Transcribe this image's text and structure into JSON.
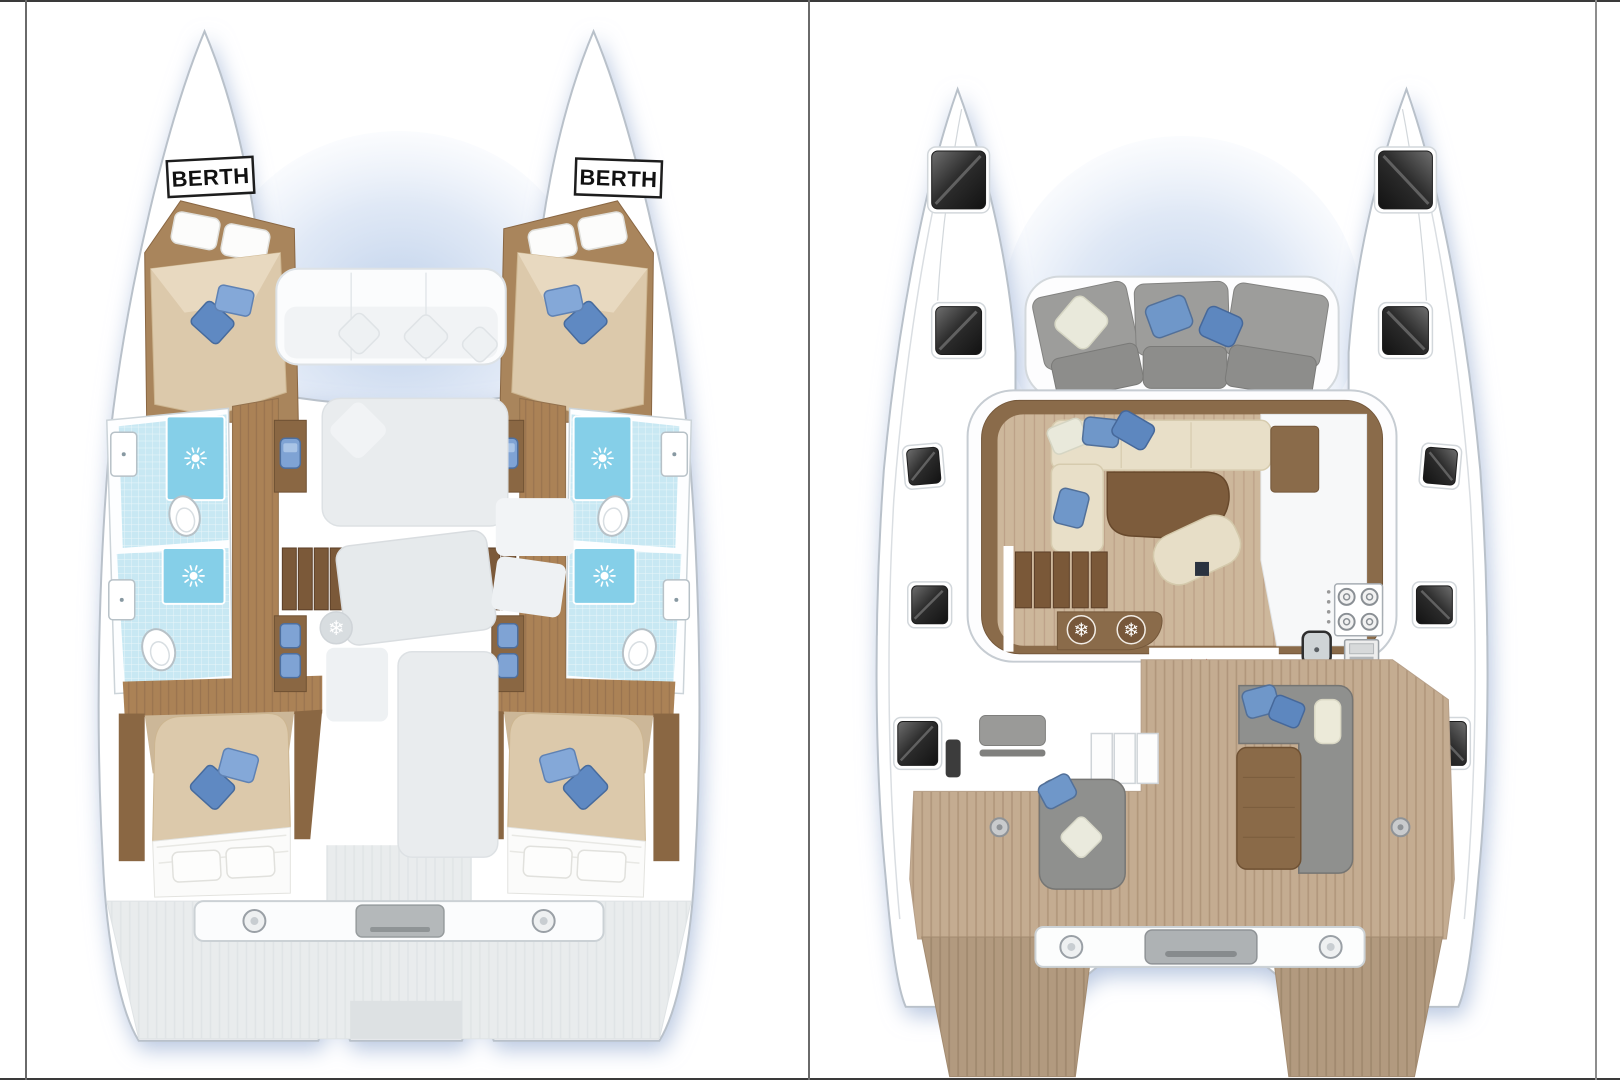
{
  "floor_plan": {
    "vessel": "catamaran",
    "views": [
      {
        "id": "lower-deck",
        "position": "left",
        "berth_labels": [
          "BERTH",
          "BERTH"
        ],
        "features": [
          "forward-berth-port",
          "forward-berth-starboard",
          "bathroom-forward-port",
          "bathroom-aft-port",
          "bathroom-forward-starboard",
          "bathroom-aft-starboard",
          "vanity-washbasins",
          "companionway-stairs",
          "aft-cabin-port",
          "aft-cabin-starboard",
          "forward-cockpit-ghost",
          "saloon-ghost",
          "aft-deck",
          "transom-beam"
        ],
        "icons": [
          "shower-rose-icon",
          "toilet-icon",
          "washbasin-icon",
          "snowflake-icon"
        ]
      },
      {
        "id": "main-deck",
        "position": "right",
        "berth_labels": [],
        "features": [
          "forward-cockpit",
          "deck-hatches",
          "saloon",
          "l-shaped-sofa",
          "dining-table",
          "chaise-seat",
          "galley",
          "stove",
          "oven",
          "galley-sink",
          "fridge-freezer",
          "companionway-stairs",
          "sliding-door",
          "aft-cockpit",
          "cockpit-sofa",
          "cockpit-table",
          "helm-bench",
          "sunbed",
          "transom-beam",
          "swim-platforms"
        ],
        "icons": [
          "snowflake-icon",
          "snowflake-icon",
          "stove-burner-icon",
          "slide-arrow-icon",
          "hatch-window-icon"
        ]
      }
    ]
  },
  "colors": {
    "hull_white": "#ffffff",
    "outline_gray": "#b9c1ca",
    "shadow_blue": "#9fb3d6",
    "wood_dark": "#8a6b4a",
    "wood_mid": "#ab8256",
    "teak": "#c4ac91",
    "plank_floor": "#cdb79b",
    "mattress_beige": "#dcc9ab",
    "sofa_cream": "#e8dfc8",
    "cushion_gray": "#9d9d9b",
    "pillow_blue": "#6f97c9",
    "pillow_blue_dark": "#5d87bf",
    "pillow_cream": "#e9e9db",
    "bathroom_cyan": "#c8e8f3",
    "shower_cyan": "#85cfe8",
    "sink_blue": "#7fa3d4",
    "arrow_red": "#b32b20",
    "hatch_dark": "#2a2a2a",
    "frame_line": "#555555"
  }
}
